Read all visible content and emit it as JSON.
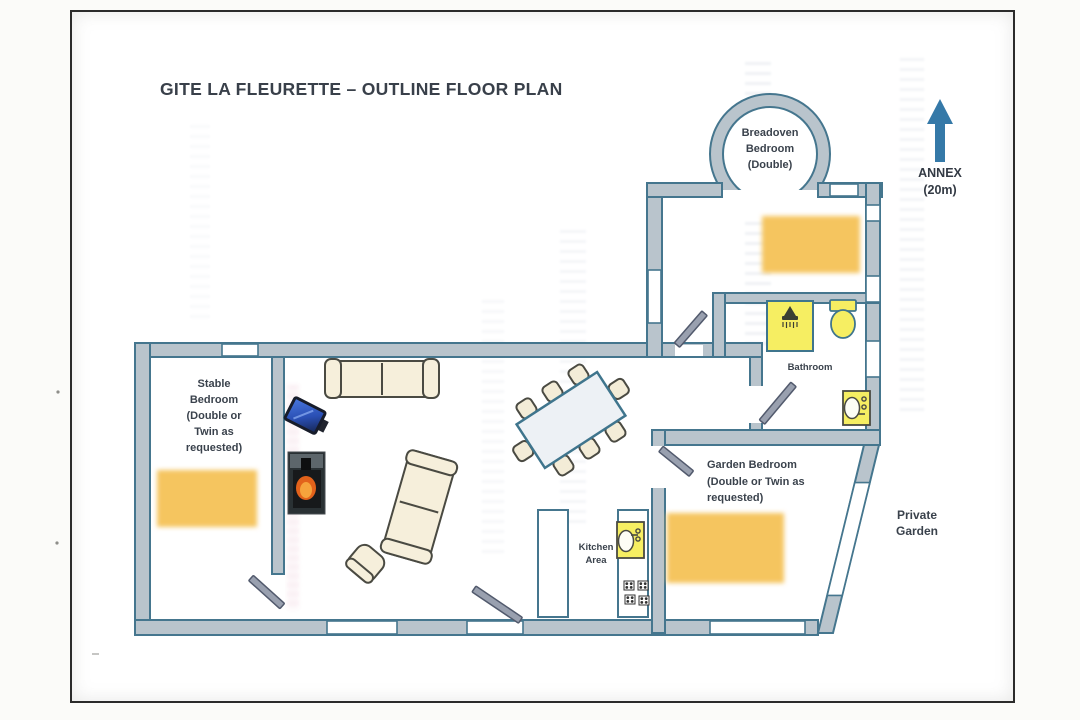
{
  "document": {
    "title": "GITE LA FLEURETTE – OUTLINE FLOOR PLAN"
  },
  "rooms": {
    "breadoven_bedroom": {
      "label": "Breadoven\nBedroom\n(Double)"
    },
    "stable_bedroom": {
      "label": "Stable\nBedroom\n(Double or\nTwin as\nrequested)"
    },
    "garden_bedroom": {
      "label": "Garden Bedroom\n(Double or Twin as\nrequested)"
    },
    "bathroom": {
      "label": "Bathroom"
    },
    "kitchen": {
      "label": "Kitchen\nArea"
    }
  },
  "outdoor": {
    "annex": {
      "label": "ANNEX\n(20m)",
      "arrow_direction": "up"
    },
    "private_garden": {
      "label": "Private\nGarden"
    }
  },
  "icons": [
    "up-arrow-icon",
    "bed",
    "shower-icon",
    "toilet-icon",
    "washbasin-icon",
    "kitchen-sink-icon",
    "hob-icon",
    "sofa",
    "armchair",
    "dining-table",
    "dining-chair",
    "tv-icon",
    "wood-stove",
    "door-swing",
    "window"
  ],
  "colors": {
    "wall_fill": "#b9c4cc",
    "wall_outline": "#45768e",
    "bed_yellow": "#f5c55e",
    "fixture_yellow": "#f6ee62",
    "furniture_cream": "#f6efdb",
    "annex_arrow_blue": "#3579a8",
    "label_text": "#3a424c"
  }
}
